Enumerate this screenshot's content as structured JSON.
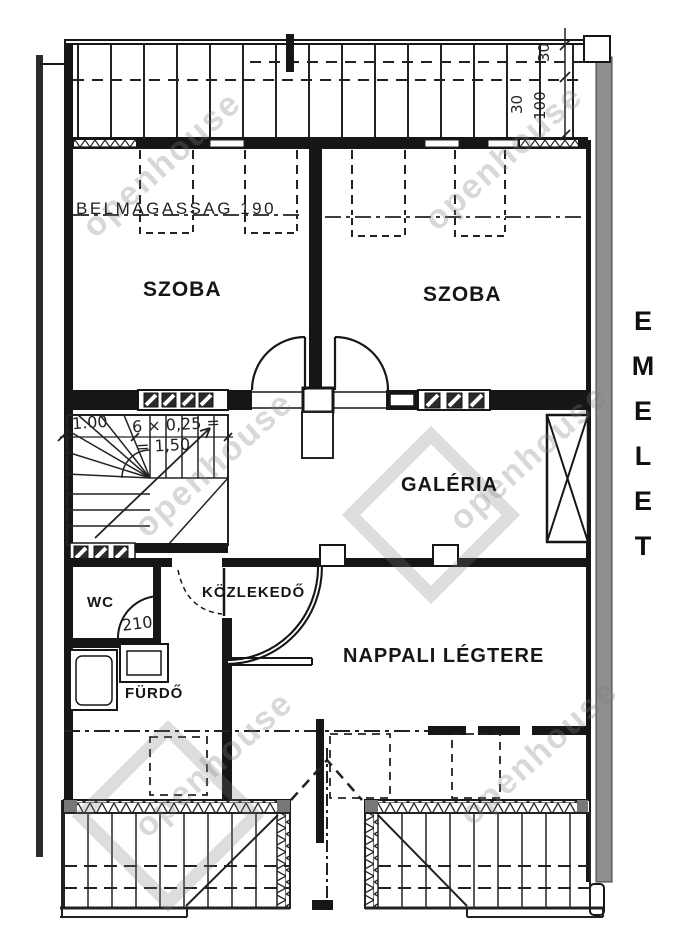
{
  "title": "EMELET floor plan",
  "floor_label": {
    "letters": [
      "E",
      "M",
      "E",
      "L",
      "E",
      "T"
    ]
  },
  "rooms": {
    "szoba_left": "SZOBA",
    "szoba_right": "SZOBA",
    "galeria": "GALÉRIA",
    "kozlekedo": "KÖZLEKEDŐ",
    "wc": "WC",
    "furdo": "FÜRDŐ",
    "nappali": "NAPPALI LÉGTERE"
  },
  "annotations": {
    "ceiling_height": "BELMAGASSAG 190",
    "stair_width": "1.00",
    "stair_formula": "6 × 0,25 =",
    "stair_result": "= 1,50",
    "door_height": "210",
    "dim_top_right_a": "30",
    "dim_top_right_b": "100",
    "dim_top_right_c": "30"
  },
  "watermark": {
    "text": "openhouse"
  },
  "colors": {
    "ink": "#1c1c1c",
    "wall_gray": "#8f8f8f",
    "watermark_gray": "#7d7d7d",
    "background": "#ffffff"
  }
}
